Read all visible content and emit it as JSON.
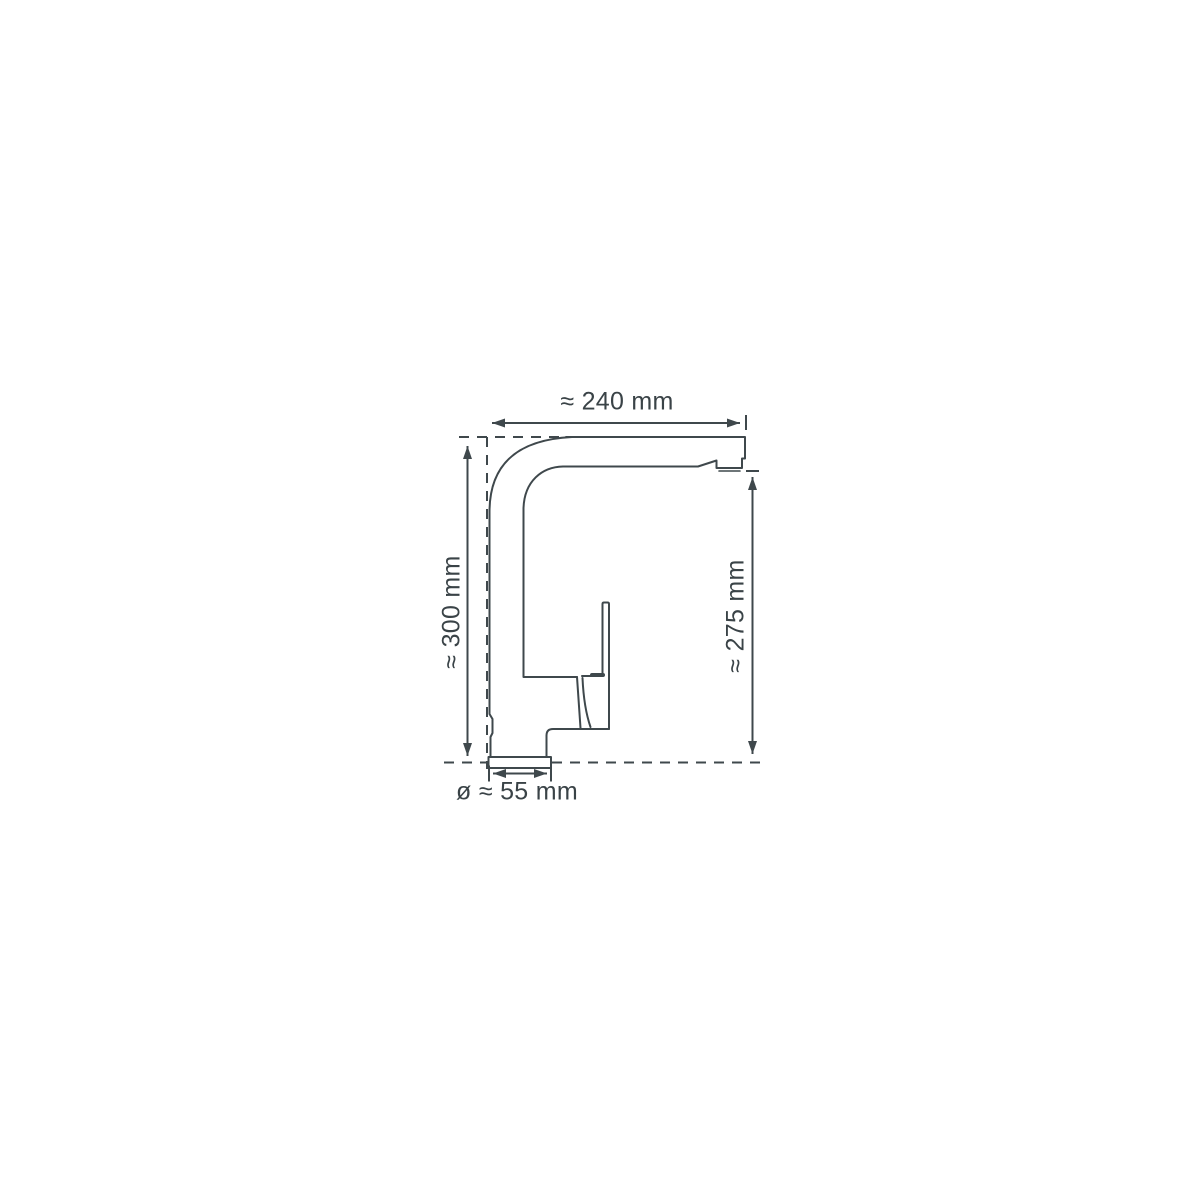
{
  "diagram": {
    "colors": {
      "line": "#3f484c",
      "text": "#3a4347",
      "background": "#ffffff"
    },
    "labels": {
      "width": "≈ 240 mm",
      "total_height": "≈ 300 mm",
      "spout_height": "≈ 275 mm",
      "base_diameter": "ø ≈ 55 mm"
    }
  }
}
